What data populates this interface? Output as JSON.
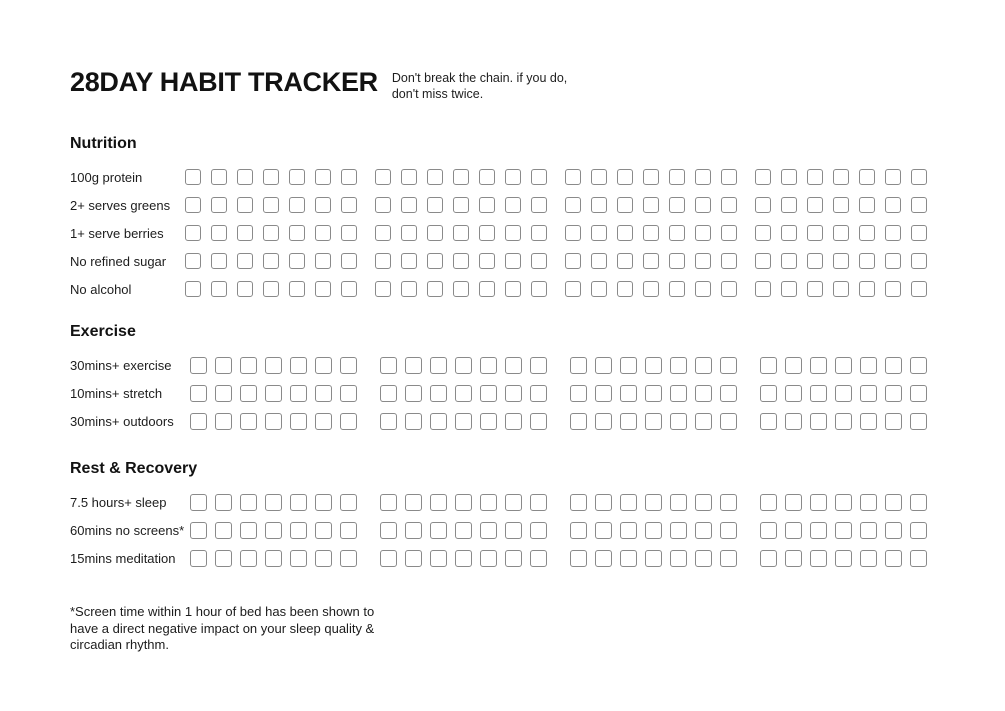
{
  "page": {
    "title": "28DAY HABIT TRACKER",
    "subtitle_lines": [
      "Don't break the chain. if you do,",
      "don't miss twice."
    ]
  },
  "tracker": {
    "total_days": 28,
    "weeks": 4,
    "days_per_week": 7,
    "checkbox_state": "unchecked",
    "sections": [
      {
        "heading": "Nutrition",
        "habits": [
          "100g protein",
          "2+ serves greens",
          "1+ serve berries",
          "No refined sugar",
          "No alcohol"
        ]
      },
      {
        "heading": "Exercise",
        "habits": [
          "30mins+ exercise",
          "10mins+ stretch",
          "30mins+ outdoors"
        ]
      },
      {
        "heading": "Rest & Recovery",
        "habits": [
          "7.5 hours+ sleep",
          "60mins no screens*",
          "15mins meditation"
        ]
      }
    ]
  },
  "footnote": {
    "lines": [
      "*Screen time within 1 hour of bed has been shown to",
      "have a direct negative impact on your sleep quality &",
      "circadian rhythm."
    ]
  },
  "colors": {
    "background": "#ffffff",
    "text": "#151515",
    "checkbox_border": "#8a8a8a"
  }
}
